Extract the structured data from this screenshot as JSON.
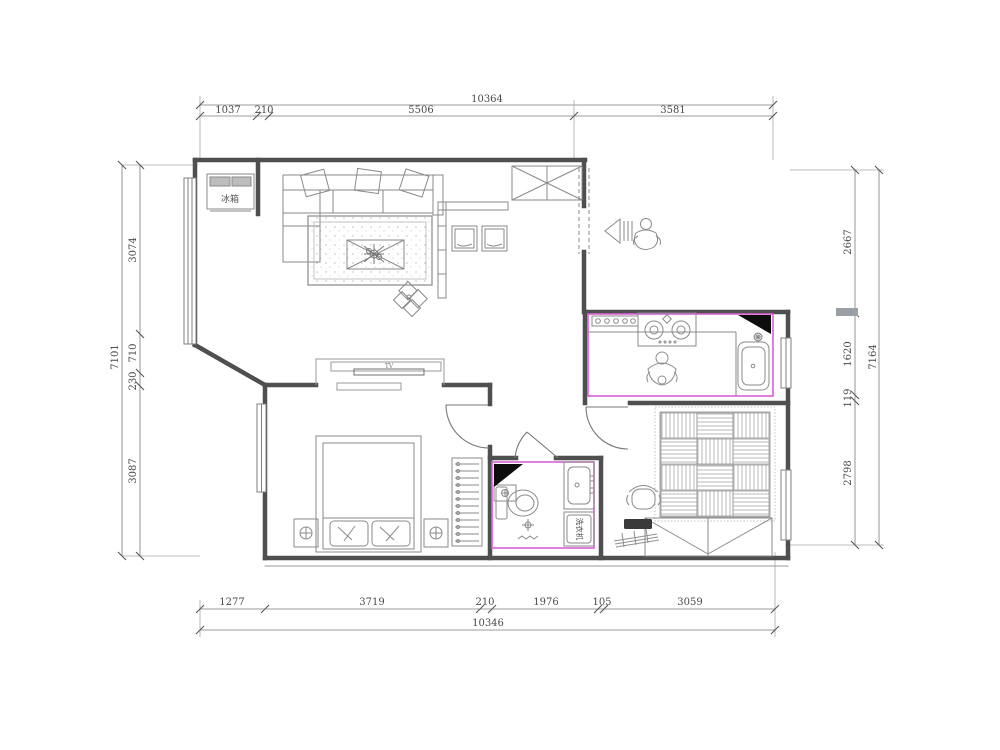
{
  "plan": {
    "labels": {
      "fridge": "冰箱",
      "washer": "洗衣机",
      "tv": "TV"
    },
    "colors": {
      "accent": "#d95fd9",
      "wall": "#4f4f4f",
      "furniture": "#8a8a8a",
      "black": "#0d0d0d"
    }
  },
  "dimensions": {
    "top": {
      "total": "10364",
      "segments": [
        "1037",
        "210",
        "5506",
        "3581"
      ]
    },
    "bottom": {
      "total": "10346",
      "segments": [
        "1277",
        "3719",
        "210",
        "1976",
        "105",
        "3059"
      ]
    },
    "left": {
      "total": "7101",
      "segments": [
        "3074",
        "710",
        "230",
        "3087"
      ]
    },
    "right": {
      "total": "7164",
      "segments": [
        "2667",
        "1620",
        "119",
        "2798"
      ]
    }
  }
}
